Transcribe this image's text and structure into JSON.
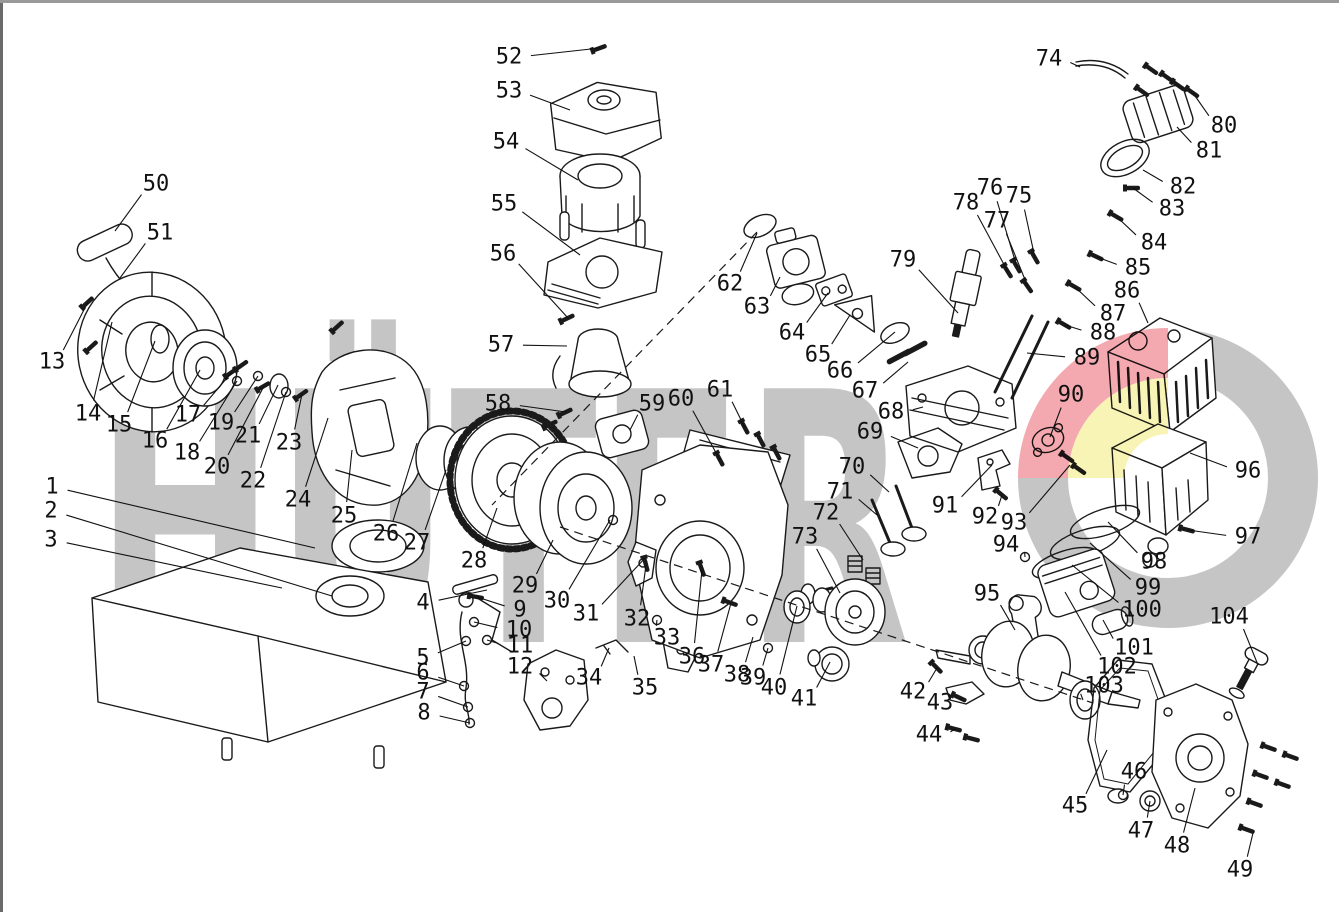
{
  "meta": {
    "title": "Engine exploded parts diagram",
    "canvas_w": 1339,
    "canvas_h": 912,
    "line_color": "#1a1a1a",
    "border_color": "#8a8a8a"
  },
  "watermark": {
    "text": "HÜTER",
    "letter_color": "#c5c5c5",
    "logo_gray": "#c5c5c5",
    "logo_red": "#f2a0a6",
    "logo_yellow": "#f8f3ae"
  },
  "callouts": [
    [
      1,
      52,
      487,
      315,
      548
    ],
    [
      2,
      51,
      511,
      332,
      596
    ],
    [
      3,
      51,
      540,
      282,
      588
    ],
    [
      4,
      423,
      603,
      487,
      590
    ],
    [
      5,
      423,
      658,
      466,
      641
    ],
    [
      6,
      423,
      673,
      464,
      686
    ],
    [
      7,
      423,
      692,
      468,
      707
    ],
    [
      8,
      424,
      713,
      470,
      723
    ],
    [
      9,
      520,
      610,
      477,
      597
    ],
    [
      10,
      519,
      630,
      474,
      622
    ],
    [
      11,
      520,
      646,
      487,
      640
    ],
    [
      12,
      520,
      667,
      547,
      681
    ],
    [
      13,
      52,
      362,
      88,
      302
    ],
    [
      14,
      88,
      414,
      112,
      322
    ],
    [
      15,
      119,
      425,
      155,
      341
    ],
    [
      16,
      155,
      441,
      200,
      370
    ],
    [
      17,
      188,
      415,
      232,
      372
    ],
    [
      18,
      187,
      453,
      237,
      381
    ],
    [
      19,
      221,
      423,
      258,
      376
    ],
    [
      20,
      217,
      467,
      264,
      386
    ],
    [
      21,
      248,
      436,
      278,
      385
    ],
    [
      22,
      253,
      481,
      286,
      392
    ],
    [
      23,
      289,
      443,
      302,
      394
    ],
    [
      24,
      298,
      500,
      328,
      418
    ],
    [
      25,
      344,
      516,
      352,
      450
    ],
    [
      26,
      386,
      534,
      417,
      443
    ],
    [
      27,
      417,
      543,
      446,
      470
    ],
    [
      28,
      474,
      561,
      497,
      508
    ],
    [
      29,
      525,
      586,
      553,
      540
    ],
    [
      30,
      557,
      601,
      610,
      520
    ],
    [
      31,
      586,
      614,
      645,
      558
    ],
    [
      32,
      637,
      619,
      646,
      565
    ],
    [
      33,
      667,
      638,
      657,
      620
    ],
    [
      34,
      589,
      678,
      609,
      648
    ],
    [
      35,
      645,
      688,
      634,
      656
    ],
    [
      36,
      692,
      657,
      702,
      570
    ],
    [
      37,
      711,
      665,
      731,
      603
    ],
    [
      38,
      737,
      675,
      753,
      637
    ],
    [
      39,
      753,
      678,
      768,
      648
    ],
    [
      40,
      774,
      688,
      797,
      606
    ],
    [
      41,
      804,
      699,
      830,
      662
    ],
    [
      42,
      913,
      692,
      937,
      668
    ],
    [
      43,
      940,
      703,
      960,
      698
    ],
    [
      44,
      929,
      735,
      955,
      729
    ],
    [
      45,
      1075,
      806,
      1107,
      750
    ],
    [
      46,
      1134,
      772,
      1123,
      795
    ],
    [
      47,
      1141,
      831,
      1150,
      801
    ],
    [
      48,
      1177,
      846,
      1195,
      788
    ],
    [
      49,
      1240,
      870,
      1253,
      833
    ],
    [
      50,
      156,
      184,
      115,
      231
    ],
    [
      51,
      160,
      233,
      120,
      278
    ],
    [
      52,
      509,
      57,
      600,
      48
    ],
    [
      53,
      509,
      91,
      570,
      110
    ],
    [
      54,
      506,
      142,
      578,
      180
    ],
    [
      55,
      504,
      204,
      580,
      255
    ],
    [
      56,
      503,
      254,
      568,
      318
    ],
    [
      57,
      501,
      345,
      567,
      346
    ],
    [
      58,
      498,
      404,
      566,
      412
    ],
    [
      59,
      652,
      404,
      630,
      430
    ],
    [
      60,
      681,
      399,
      720,
      460
    ],
    [
      61,
      720,
      390,
      745,
      428
    ],
    [
      62,
      730,
      284,
      757,
      233
    ],
    [
      63,
      757,
      307,
      780,
      277
    ],
    [
      64,
      792,
      333,
      828,
      293
    ],
    [
      65,
      818,
      355,
      850,
      315
    ],
    [
      66,
      840,
      371,
      895,
      332
    ],
    [
      67,
      865,
      391,
      908,
      362
    ],
    [
      68,
      891,
      412,
      923,
      407
    ],
    [
      69,
      870,
      432,
      918,
      448
    ],
    [
      70,
      852,
      467,
      889,
      492
    ],
    [
      71,
      840,
      492,
      877,
      515
    ],
    [
      72,
      826,
      513,
      863,
      560
    ],
    [
      73,
      805,
      537,
      840,
      593
    ],
    [
      74,
      1049,
      59,
      1080,
      67
    ],
    [
      75,
      1019,
      196,
      1035,
      258
    ],
    [
      76,
      990,
      188,
      1017,
      267
    ],
    [
      77,
      997,
      221,
      1028,
      287
    ],
    [
      78,
      966,
      203,
      1008,
      272
    ],
    [
      79,
      903,
      260,
      958,
      313
    ],
    [
      80,
      1224,
      126,
      1193,
      93
    ],
    [
      81,
      1209,
      151,
      1177,
      127
    ],
    [
      82,
      1183,
      187,
      1143,
      170
    ],
    [
      83,
      1172,
      209,
      1133,
      188
    ],
    [
      84,
      1154,
      243,
      1117,
      217
    ],
    [
      85,
      1138,
      268,
      1097,
      257
    ],
    [
      86,
      1127,
      291,
      1148,
      323
    ],
    [
      87,
      1113,
      314,
      1075,
      287
    ],
    [
      88,
      1103,
      333,
      1065,
      325
    ],
    [
      89,
      1087,
      358,
      1027,
      353
    ],
    [
      90,
      1071,
      395,
      1050,
      437
    ],
    [
      91,
      945,
      506,
      992,
      465
    ],
    [
      92,
      985,
      517,
      1002,
      495
    ],
    [
      93,
      1014,
      523,
      1070,
      465
    ],
    [
      94,
      1006,
      545,
      1025,
      557
    ],
    [
      95,
      987,
      594,
      1015,
      630
    ],
    [
      96,
      1248,
      471,
      1190,
      453
    ],
    [
      97,
      1248,
      537,
      1188,
      530
    ],
    [
      98,
      1154,
      562,
      1108,
      522
    ],
    [
      99,
      1148,
      588,
      1090,
      543
    ],
    [
      100,
      1142,
      610,
      1072,
      565
    ],
    [
      101,
      1134,
      648,
      1103,
      620
    ],
    [
      102,
      1117,
      667,
      1065,
      592
    ],
    [
      103,
      1104,
      686,
      1083,
      700
    ],
    [
      104,
      1229,
      617,
      1258,
      665
    ]
  ],
  "small_parts": [
    [
      "b",
      600,
      48,
      -20
    ],
    [
      "b",
      568,
      318,
      -25
    ],
    [
      "b",
      566,
      412,
      -25
    ],
    [
      "b",
      551,
      424,
      -25
    ],
    [
      "b",
      720,
      460,
      62
    ],
    [
      "b",
      745,
      428,
      62
    ],
    [
      "b",
      761,
      441,
      62
    ],
    [
      "b",
      777,
      454,
      62
    ],
    [
      "b",
      646,
      565,
      75
    ],
    [
      "b",
      702,
      570,
      70
    ],
    [
      "b",
      731,
      603,
      20
    ],
    [
      "b",
      937,
      668,
      45
    ],
    [
      "b",
      955,
      729,
      15
    ],
    [
      "b",
      973,
      739,
      15
    ],
    [
      "b",
      1035,
      258,
      60
    ],
    [
      "b",
      1017,
      267,
      60
    ],
    [
      "b",
      1028,
      287,
      55
    ],
    [
      "b",
      1008,
      272,
      58
    ],
    [
      "b",
      1193,
      93,
      35
    ],
    [
      "b",
      1179,
      86,
      35
    ],
    [
      "b",
      1152,
      70,
      35
    ],
    [
      "b",
      1168,
      78,
      35
    ],
    [
      "b",
      1143,
      92,
      35
    ],
    [
      "b",
      1117,
      217,
      30
    ],
    [
      "b",
      1097,
      257,
      25
    ],
    [
      "b",
      1075,
      287,
      30
    ],
    [
      "b",
      1065,
      325,
      30
    ],
    [
      "b",
      1133,
      188,
      0
    ],
    [
      "b",
      1002,
      495,
      40
    ],
    [
      "b",
      1188,
      530,
      15
    ],
    [
      "b",
      302,
      394,
      -35
    ],
    [
      "b",
      232,
      372,
      -35
    ],
    [
      "b",
      88,
      302,
      -42
    ],
    [
      "b",
      92,
      346,
      -42
    ],
    [
      "b",
      338,
      326,
      -42
    ],
    [
      "b",
      242,
      365,
      -35
    ],
    [
      "b",
      1068,
      458,
      35
    ],
    [
      "b",
      1080,
      470,
      35
    ],
    [
      "b",
      477,
      597,
      10
    ],
    [
      "b",
      264,
      386,
      -30
    ],
    [
      "b",
      1270,
      748,
      20
    ],
    [
      "b",
      1292,
      757,
      20
    ],
    [
      "b",
      1262,
      776,
      20
    ],
    [
      "b",
      1284,
      785,
      20
    ],
    [
      "b",
      1256,
      804,
      20
    ],
    [
      "b",
      1248,
      830,
      20
    ],
    [
      "b",
      960,
      698,
      25
    ],
    [
      "r",
      466,
      641,
      0
    ],
    [
      "r",
      464,
      686,
      0
    ],
    [
      "r",
      468,
      707,
      0
    ],
    [
      "r",
      470,
      723,
      0
    ],
    [
      "r",
      474,
      622,
      0
    ],
    [
      "r",
      487,
      640,
      0
    ],
    [
      "r",
      657,
      620,
      0
    ],
    [
      "r",
      258,
      376,
      0
    ],
    [
      "r",
      237,
      381,
      0
    ],
    [
      "r",
      286,
      392,
      0
    ],
    [
      "r",
      768,
      648,
      0
    ],
    [
      "r",
      1025,
      557,
      0
    ],
    [
      "r",
      1123,
      795,
      0
    ],
    [
      "r",
      613,
      520,
      0
    ]
  ],
  "axes_dashed": [
    [
      757,
      232,
      492,
      505
    ],
    [
      560,
      527,
      1093,
      703
    ]
  ]
}
